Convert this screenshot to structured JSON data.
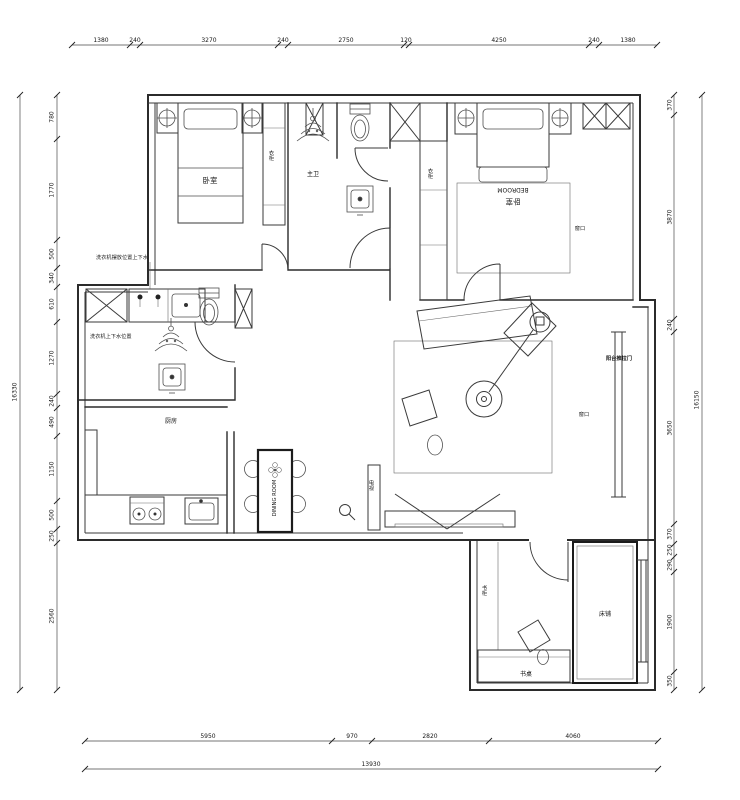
{
  "dims": {
    "top": [
      "1380",
      "240",
      "3270",
      "240",
      "2750",
      "120",
      "4250",
      "240",
      "1380"
    ],
    "left": [
      "780",
      "1770",
      "500",
      "340",
      "610",
      "1270",
      "240",
      "490",
      "1150",
      "500",
      "250",
      "2560"
    ],
    "left_total": "16330",
    "right": [
      "370",
      "3870",
      "240",
      "3650",
      "370",
      "250",
      "290",
      "1900",
      "350"
    ],
    "right_total": "16150",
    "bottom": [
      "5950",
      "970",
      "2820",
      "4060"
    ],
    "bottom_total": "13930"
  },
  "labels": {
    "bedroom1": "卧室",
    "wardrobe1": "衣柜",
    "bath_master": "主卫",
    "wardrobe2": "衣柜",
    "bedroom2_cn": "卧室",
    "bedroom2_en": "BEDROOM",
    "window_bedroom2": "窗口",
    "window_living": "窗口",
    "balcony_door": "阳台推拉门",
    "kitchen": "厨房",
    "dining_en": "DINING ROOM",
    "tv": "电视",
    "bookcase": "书柜",
    "desk": "书桌",
    "bed_study": "床铺",
    "laundry_note_top": "洗衣机摆放位置上下水",
    "laundry_note_side": "洗衣机上下水位置"
  }
}
